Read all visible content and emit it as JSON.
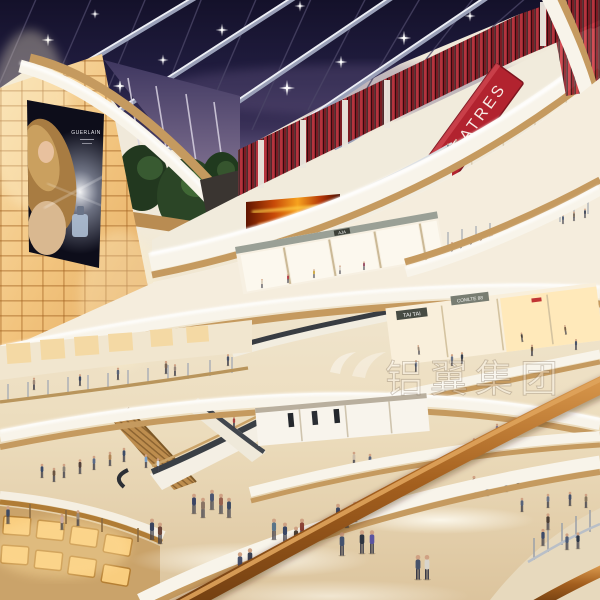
{
  "scene": {
    "description": "Architectural rendering of a multi-level shopping mall atrium at evening: dark skylight roof with lit beams, curved cream balconies, wood fascias, red cinema facade, glowing amber wall, escalators and crowds of shoppers",
    "levels_visible": 5
  },
  "signs": {
    "theatre_sign": "THEATRES",
    "billboard_brand": "GUERLAIN",
    "shop_sign_tai_tai": "TAI TAI",
    "shop_sign_comlte": "COMLTE 88",
    "shop_sign_aja": "AJA"
  },
  "watermark": {
    "text": "铝翼集团",
    "style": "translucent white outlined characters with swoosh logo"
  },
  "colors": {
    "sky_dark": "#1b1834",
    "sky_purple": "#8b7a97",
    "theatre_red": "#b2232f",
    "wood_fascia": "#c59a5f",
    "glow_amber": "#f6c87c",
    "fascia_white": "#f7f3e9",
    "floor_marble": "#e9dcc2",
    "handrail_wood": "#96571c"
  }
}
